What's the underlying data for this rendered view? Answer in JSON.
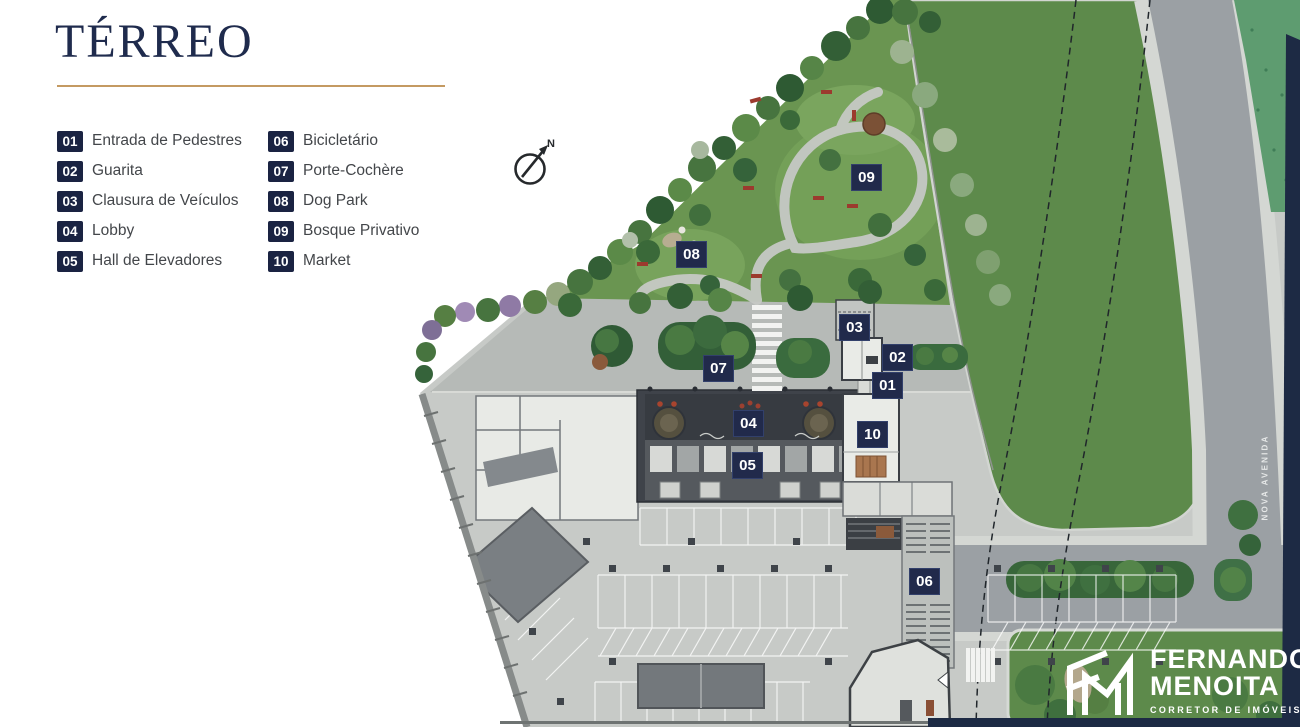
{
  "title": "TÉRREO",
  "legend": {
    "items": [
      {
        "num": "01",
        "label": "Entrada de Pedestres"
      },
      {
        "num": "02",
        "label": "Guarita"
      },
      {
        "num": "03",
        "label": "Clausura de Veículos"
      },
      {
        "num": "04",
        "label": "Lobby"
      },
      {
        "num": "05",
        "label": "Hall de Elevadores"
      },
      {
        "num": "06",
        "label": "Bicicletário"
      },
      {
        "num": "07",
        "label": "Porte-Cochère"
      },
      {
        "num": "08",
        "label": "Dog Park"
      },
      {
        "num": "09",
        "label": "Bosque Privativo"
      },
      {
        "num": "10",
        "label": "Market"
      }
    ]
  },
  "plan": {
    "markers": [
      {
        "num": "01"
      },
      {
        "num": "02"
      },
      {
        "num": "03"
      },
      {
        "num": "04"
      },
      {
        "num": "05"
      },
      {
        "num": "06"
      },
      {
        "num": "07"
      },
      {
        "num": "08"
      },
      {
        "num": "09"
      },
      {
        "num": "10"
      }
    ],
    "street_label": "NOVA AVENIDA",
    "compass_label": "N"
  },
  "logo": {
    "name_line1": "FERNANDO",
    "name_line2": "MENOITA",
    "tagline": "CORRETOR DE IMÓVEIS"
  },
  "colors": {
    "navy_title": "#1f2b4d",
    "gold_rule": "#c49a62",
    "marker_navy": "#212a4b",
    "legend_text": "#43464a",
    "field_green": "#5d8a4b",
    "garden_green": "#6a9551",
    "road_gray": "#9ba0a4",
    "pavement_gray": "#c7cac7",
    "building_charcoal": "#3f434a",
    "border_navy": "#1d2a44"
  }
}
